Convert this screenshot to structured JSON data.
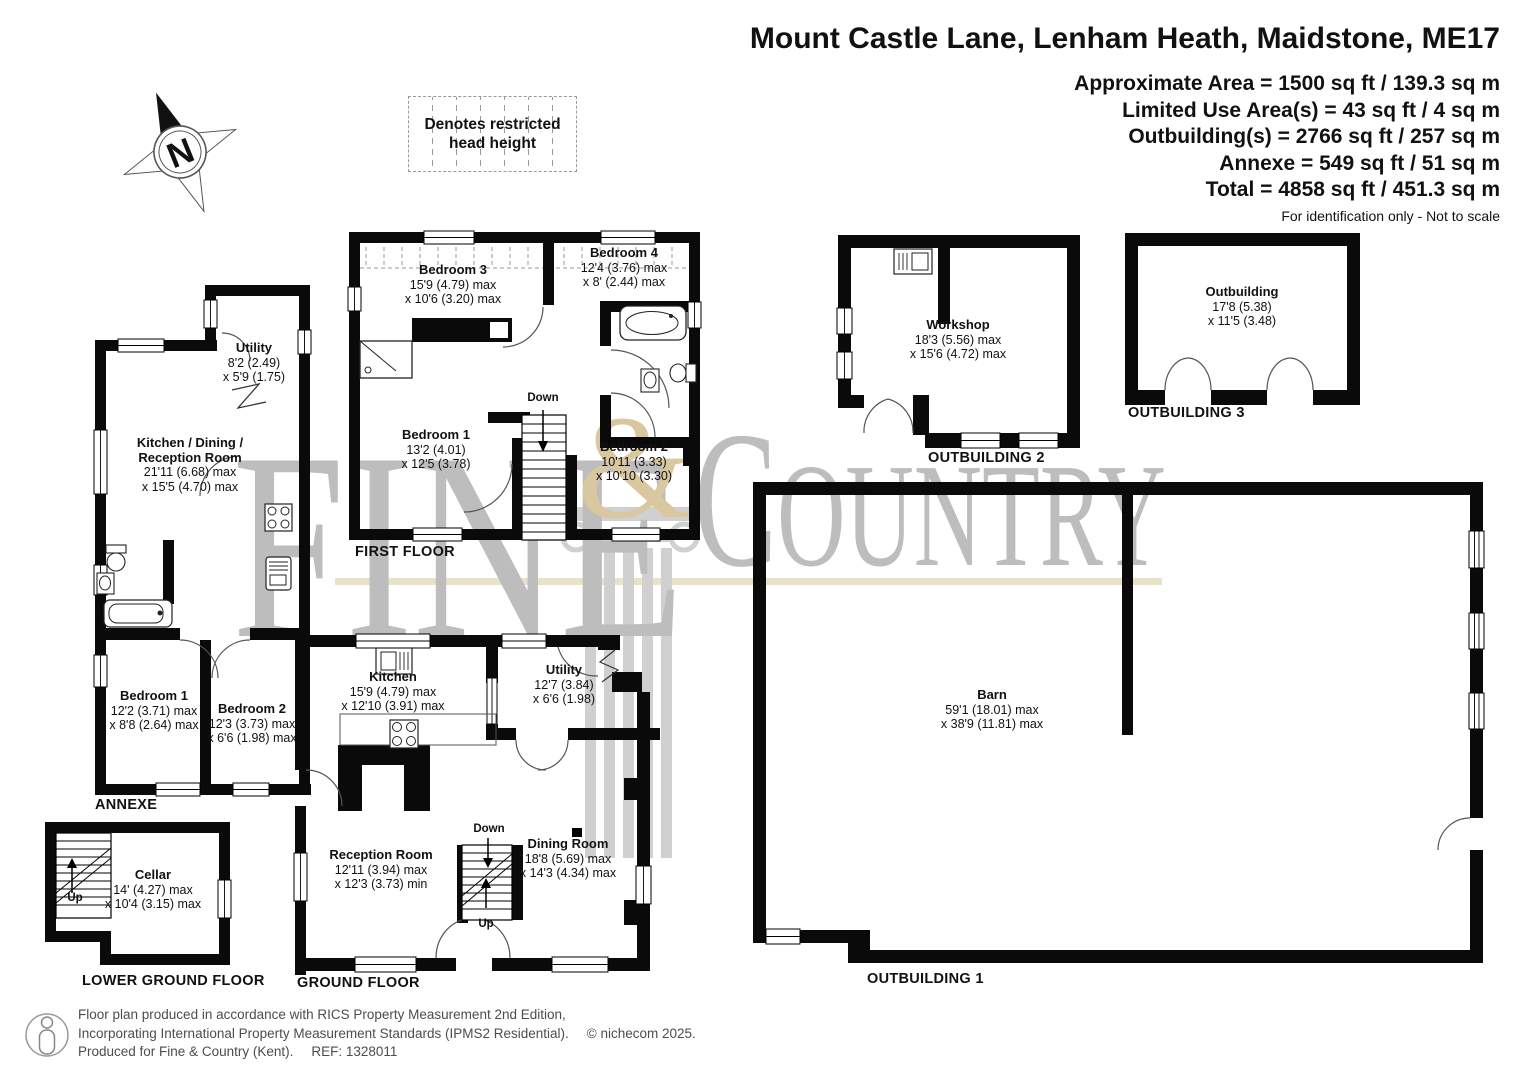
{
  "header": {
    "title": "Mount Castle Lane, Lenham Heath, Maidstone, ME17",
    "area_lines": [
      "Approximate Area = 1500 sq ft / 139.3 sq m",
      "Limited Use Area(s) = 43 sq ft / 4 sq m",
      "Outbuilding(s) = 2766 sq ft / 257 sq m",
      "Annexe = 549 sq ft / 51 sq m",
      "Total = 4858 sq ft / 451.3 sq m"
    ],
    "disclaimer": "For identification only - Not to scale"
  },
  "legend": {
    "line1": "Denotes restricted",
    "line2": "head height"
  },
  "compass": {
    "letter": "N"
  },
  "watermark": {
    "word1": "FINE",
    "amp": "&",
    "word2_initial": "C",
    "word2_rest": "OUNTRY",
    "gray": "#bdbdbd",
    "gold": "#d9c89f",
    "line": "#eae2c8"
  },
  "plans": {
    "first_floor": {
      "label": "FIRST FLOOR",
      "stairs": {
        "down": "Down"
      },
      "rooms": [
        {
          "name": "Bedroom 3",
          "d1": "15'9 (4.79) max",
          "d2": "x 10'6 (3.20) max"
        },
        {
          "name": "Bedroom 4",
          "d1": "12'4 (3.76) max",
          "d2": "x 8' (2.44) max"
        },
        {
          "name": "Bedroom 1",
          "d1": "13'2 (4.01)",
          "d2": "x 12'5 (3.78)"
        },
        {
          "name": "Bedroom 2",
          "d1": "10'11 (3.33)",
          "d2": "x 10'10 (3.30)"
        }
      ]
    },
    "annexe": {
      "label": "ANNEXE",
      "rooms": [
        {
          "name": "Utility",
          "d1": "8'2 (2.49)",
          "d2": "x 5'9 (1.75)"
        },
        {
          "name": "Kitchen / Dining /",
          "name2": "Reception Room",
          "d1": "21'11 (6.68) max",
          "d2": "x 15'5 (4.70) max"
        },
        {
          "name": "Bedroom 1",
          "d1": "12'2 (3.71) max",
          "d2": "x 8'8 (2.64) max"
        },
        {
          "name": "Bedroom 2",
          "d1": "12'3 (3.73) max",
          "d2": "x 6'6 (1.98) max"
        }
      ]
    },
    "ground_floor": {
      "label": "GROUND FLOOR",
      "stairs": {
        "down": "Down",
        "up": "Up"
      },
      "rooms": [
        {
          "name": "Kitchen",
          "d1": "15'9 (4.79) max",
          "d2": "x 12'10 (3.91) max"
        },
        {
          "name": "Utility",
          "d1": "12'7 (3.84)",
          "d2": "x 6'6 (1.98)"
        },
        {
          "name": "Reception Room",
          "d1": "12'11 (3.94) max",
          "d2": "x 12'3 (3.73) min"
        },
        {
          "name": "Dining Room",
          "d1": "18'8 (5.69) max",
          "d2": "x 14'3 (4.34) max"
        }
      ]
    },
    "lower_ground": {
      "label": "LOWER GROUND FLOOR",
      "stairs": {
        "up": "Up"
      },
      "rooms": [
        {
          "name": "Cellar",
          "d1": "14' (4.27) max",
          "d2": "x 10'4 (3.15) max"
        }
      ]
    },
    "outbuilding2": {
      "label": "OUTBUILDING 2",
      "rooms": [
        {
          "name": "Workshop",
          "d1": "18'3 (5.56) max",
          "d2": "x 15'6 (4.72) max"
        }
      ]
    },
    "outbuilding3": {
      "label": "OUTBUILDING 3",
      "rooms": [
        {
          "name": "Outbuilding",
          "d1": "17'8 (5.38)",
          "d2": "x 11'5 (3.48)"
        }
      ]
    },
    "outbuilding1": {
      "label": "OUTBUILDING 1",
      "rooms": [
        {
          "name": "Barn",
          "d1": "59'1 (18.01) max",
          "d2": "x 38'9 (11.81) max"
        }
      ]
    }
  },
  "footer": {
    "line1": "Floor plan produced in accordance with RICS Property Measurement 2nd Edition,",
    "line2": "Incorporating International Property Measurement Standards (IPMS2 Residential).",
    "copyright": "© nichecom 2025.",
    "line3": "Produced for Fine & Country (Kent).",
    "ref": "REF:  1328011"
  }
}
